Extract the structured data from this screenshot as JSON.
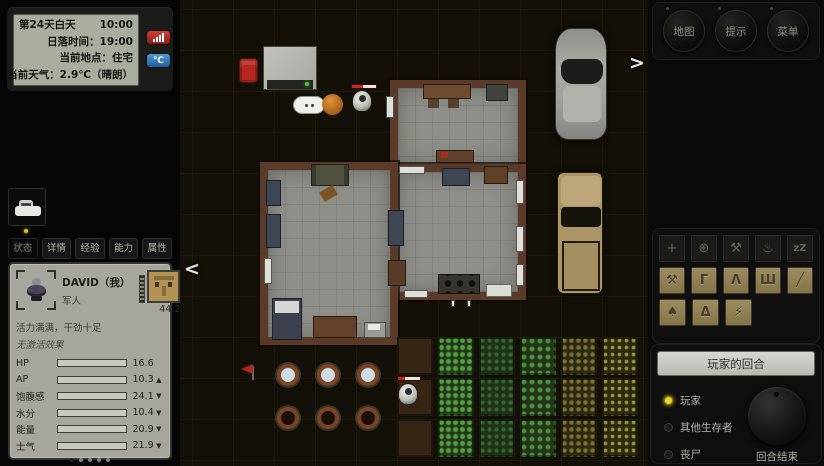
{
  "hud": {
    "day": "第24天白天",
    "time": "10:00",
    "sunset": "日落时间：19:00",
    "location": "当前地点：住宅",
    "weather": "当前天气：2.9℃（晴朗）",
    "celsius": "℃"
  },
  "tabs": [
    {
      "label": "状态",
      "active": true
    },
    {
      "label": "详情",
      "active": false
    },
    {
      "label": "经验",
      "active": false
    },
    {
      "label": "能力",
      "active": false
    },
    {
      "label": "属性",
      "active": false
    }
  ],
  "character": {
    "name": "DAVID（我）",
    "profession": "军人",
    "equip_value": "44.2",
    "mood": "活力满满，干劲十足",
    "effects": "无激活效果",
    "stats": [
      {
        "label": "HP",
        "value": "16.6",
        "pct": 83,
        "trend": ""
      },
      {
        "label": "AP",
        "value": "10.3",
        "pct": 52,
        "trend": "▲"
      },
      {
        "label": "饱腹感",
        "value": "24.1",
        "pct": 83,
        "trend": "▼"
      },
      {
        "label": "水分",
        "value": "10.4",
        "pct": 56,
        "trend": "▼"
      },
      {
        "label": "能量",
        "value": "20.9",
        "pct": 85,
        "trend": "▼"
      },
      {
        "label": "士气",
        "value": "21.9",
        "pct": 93,
        "trend": "▼"
      }
    ],
    "pager_pages": 5,
    "pager_active_index": 0
  },
  "map": {
    "nav_left": "<",
    "nav_right": ">"
  },
  "right_panel": {
    "top_buttons": [
      {
        "label": "地图"
      },
      {
        "label": "提示"
      },
      {
        "label": "菜单"
      }
    ],
    "actions_row1": [
      {
        "name": "move",
        "glyph": "+"
      },
      {
        "name": "aim",
        "glyph": "⊕"
      },
      {
        "name": "craft-anvil",
        "glyph": "⚒"
      },
      {
        "name": "cook",
        "glyph": "♨"
      },
      {
        "name": "sleep",
        "glyph": "zZ"
      }
    ],
    "actions_row2": [
      {
        "name": "hammer",
        "glyph": "⚒"
      },
      {
        "name": "crowbar",
        "glyph": "Γ"
      },
      {
        "name": "campfire-tripod",
        "glyph": "Λ"
      },
      {
        "name": "rake",
        "glyph": "Ш"
      },
      {
        "name": "knife",
        "glyph": "╱"
      }
    ],
    "actions_row3": [
      {
        "name": "shovel",
        "glyph": "♠"
      },
      {
        "name": "tent",
        "glyph": "Δ"
      },
      {
        "name": "flashlight",
        "glyph": "⚡"
      }
    ],
    "turn_banner": "玩家的回合",
    "legend": [
      {
        "label": "玩家",
        "color": "#e8d52a"
      },
      {
        "label": "其他生存者",
        "color": "#1d1d1b"
      },
      {
        "label": "丧尸",
        "color": "#1d1d1b"
      }
    ],
    "end_turn": "回合结束"
  },
  "colors": {
    "accent_red_button": "#b02c22",
    "accent_blue_button": "#2c7fc0",
    "player_yellow": "#e8d52a",
    "health_red": "#c9291f",
    "lcd_background": "#a9ada0",
    "panel_gray": "#a6a69e"
  }
}
